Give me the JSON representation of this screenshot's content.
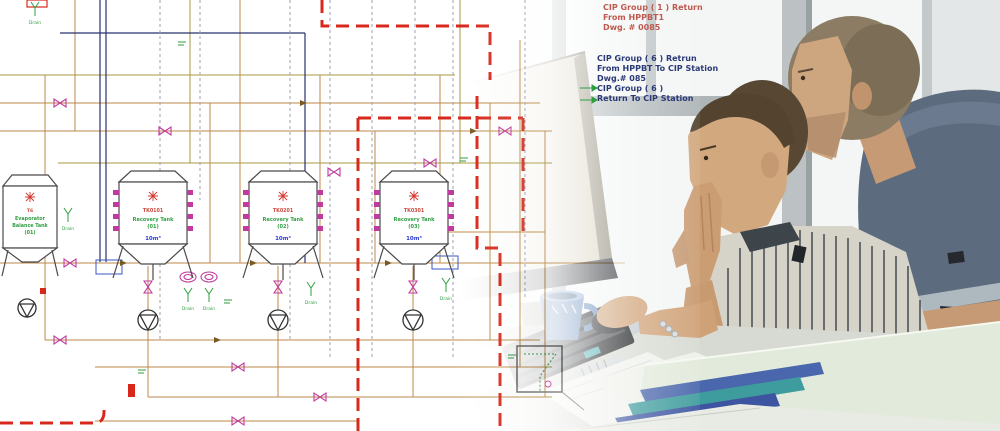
{
  "diagram": {
    "annotation_red": [
      "CIP Group ( 1 ) Return",
      "From HPPBT1",
      "Dwg. # 0085"
    ],
    "annotation_blue": [
      "CIP Group ( 6 ) Retrun",
      "From HPPBT  To CIP Station",
      "Dwg.# 085",
      "CIP Group ( 6 )",
      "Return To CIP Station"
    ],
    "tanks": [
      {
        "id": "T6",
        "name": [
          "Evaporator",
          "Balance Tank",
          "(01)"
        ],
        "volume": ""
      },
      {
        "id": "TK0101",
        "name": [
          "Recovery Tank",
          "(01)"
        ],
        "volume": "10m³"
      },
      {
        "id": "TK0201",
        "name": [
          "Recovery Tank",
          "(02)"
        ],
        "volume": "10m³"
      },
      {
        "id": "TK0301",
        "name": [
          "Recovery Tank",
          "(03)"
        ],
        "volume": "10m³"
      }
    ],
    "drain_label": "Drain",
    "colors": {
      "pipe_orange": "#bd8a48",
      "pipe_olive": "#a89a3e",
      "cip_red": "#d8281c",
      "valve_magenta": "#c13a9e",
      "drain_green": "#2f9e41",
      "volume_blue": "#2b3bd4",
      "tank_id_red": "#cc4a3e",
      "navy_line": "#2a3370",
      "dashed_gray": "#9aa2b2",
      "annotation_red": "#c05a50",
      "annotation_blue": "#2b3a77"
    }
  },
  "photo": {
    "colors": {
      "mug_blue": "#5d83b5",
      "shirt_standing": "#5d6b7e",
      "shirt_seated_stripe": "#565c60",
      "binder_blue": "#4a66ad",
      "binder_teal": "#3f9c9e",
      "folder_green": "#e2eadb"
    }
  }
}
